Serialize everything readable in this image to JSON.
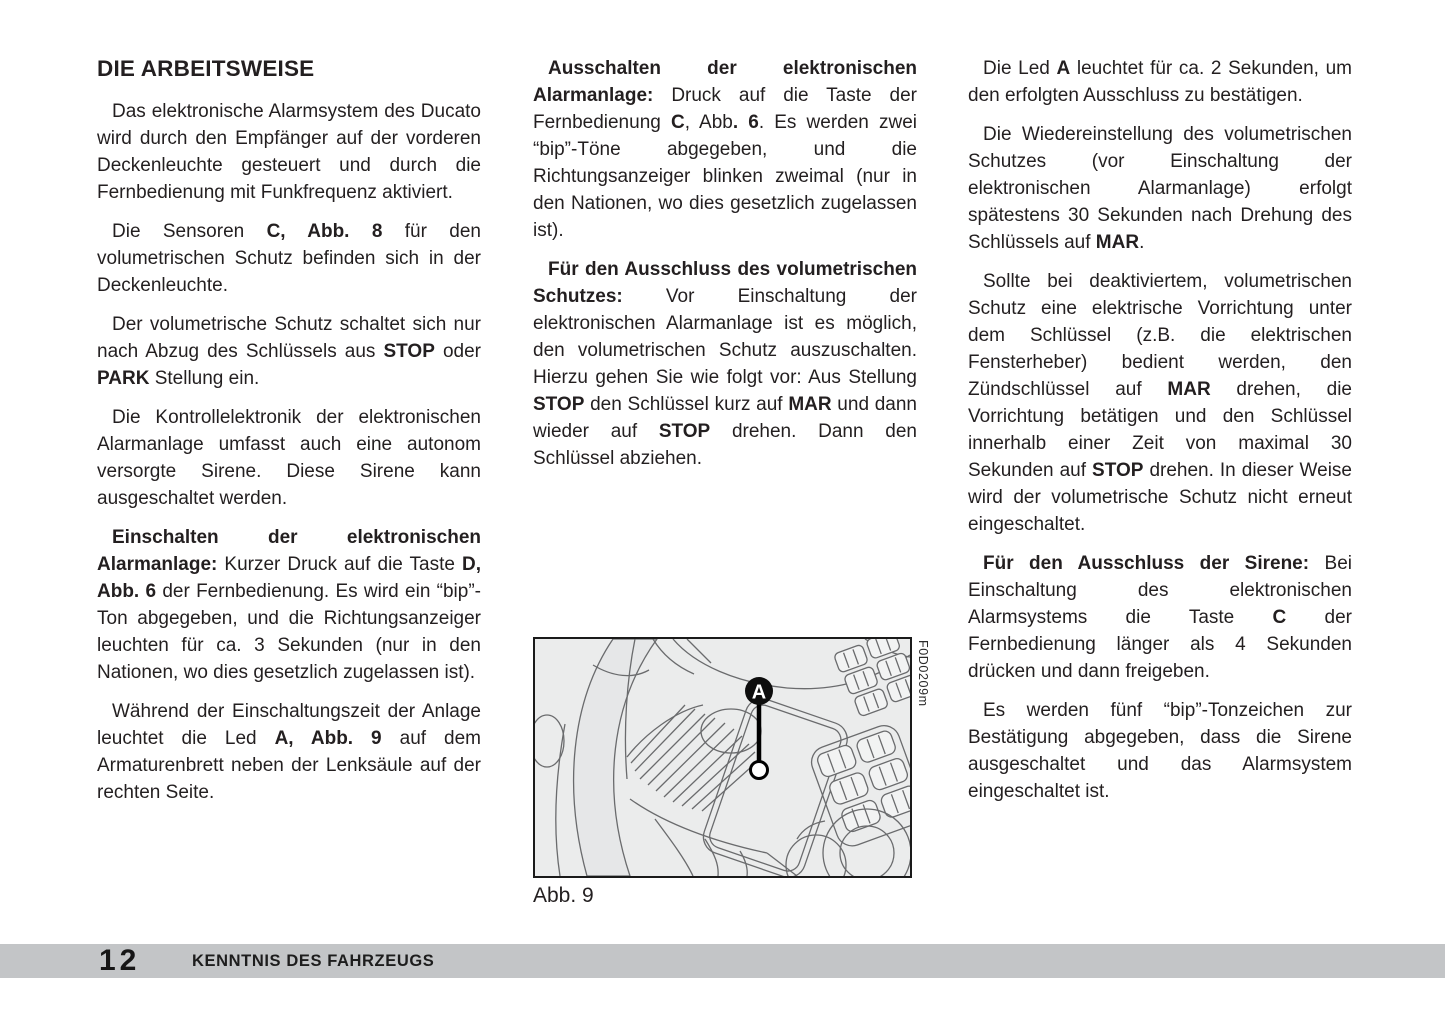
{
  "columns": {
    "left": {
      "heading": "DIE ARBEITSWEISE",
      "paragraphs": [
        {
          "segments": [
            {
              "t": "Das elektronische Alarmsystem des Ducato wird durch den Empfänger auf der vorderen Deckenleuchte gesteuert und durch die Fernbedienung mit Funkfrequenz aktiviert.",
              "b": false
            }
          ]
        },
        {
          "segments": [
            {
              "t": "Die Sensoren ",
              "b": false
            },
            {
              "t": "C, Abb. 8",
              "b": true
            },
            {
              "t": " für den volumetrischen Schutz befinden sich in der Deckenleuchte.",
              "b": false
            }
          ]
        },
        {
          "segments": [
            {
              "t": "Der volumetrische Schutz schaltet sich nur nach Abzug des Schlüssels aus ",
              "b": false
            },
            {
              "t": "STOP",
              "b": true
            },
            {
              "t": " oder ",
              "b": false
            },
            {
              "t": "PARK",
              "b": true
            },
            {
              "t": " Stellung ein.",
              "b": false
            }
          ]
        },
        {
          "segments": [
            {
              "t": "Die Kontrollelektronik der elektronischen Alarmanlage umfasst auch eine autonom versorgte Sirene. Diese Sirene kann ausgeschaltet werden.",
              "b": false
            }
          ]
        },
        {
          "segments": [
            {
              "t": "Einschalten der elektronischen Alarmanlage:",
              "b": true
            },
            {
              "t": " Kurzer Druck auf die Taste ",
              "b": false
            },
            {
              "t": "D, Abb. 6",
              "b": true
            },
            {
              "t": " der Fernbedienung. Es wird ein “bip”-Ton abgegeben, und die Richtungsanzeiger leuchten für ca. 3 Sekunden (nur in den Nationen, wo dies gesetzlich zugelassen ist).",
              "b": false
            }
          ]
        },
        {
          "segments": [
            {
              "t": "Während der Einschaltungszeit der Anlage leuchtet die Led ",
              "b": false
            },
            {
              "t": "A, Abb. 9",
              "b": true
            },
            {
              "t": " auf dem Armaturenbrett neben der Lenksäule auf der rechten Seite.",
              "b": false
            }
          ]
        }
      ]
    },
    "middle": {
      "paragraphs": [
        {
          "segments": [
            {
              "t": "Ausschalten der elektronischen Alarmanlage:",
              "b": true
            },
            {
              "t": " Druck auf die Taste der Fernbedienung ",
              "b": false
            },
            {
              "t": "C",
              "b": true
            },
            {
              "t": ", Abb",
              "b": false
            },
            {
              "t": ". 6",
              "b": true
            },
            {
              "t": ". Es werden zwei “bip”-Töne abgegeben, und die Richtungsanzeiger blinken zweimal (nur in den Nationen, wo dies gesetzlich zugelassen ist).",
              "b": false
            }
          ]
        },
        {
          "segments": [
            {
              "t": "Für den Ausschluss des volumetrischen Schutzes:",
              "b": true
            },
            {
              "t": " Vor Einschaltung der elektronischen Alarmanlage ist es möglich, den volumetrischen Schutz auszuschalten. Hierzu gehen Sie wie folgt vor: Aus Stellung ",
              "b": false
            },
            {
              "t": "STOP",
              "b": true
            },
            {
              "t": " den Schlüssel kurz auf ",
              "b": false
            },
            {
              "t": "MAR",
              "b": true
            },
            {
              "t": " und dann wieder auf ",
              "b": false
            },
            {
              "t": "STOP",
              "b": true
            },
            {
              "t": " drehen. Dann den Schlüssel abziehen.",
              "b": false
            }
          ]
        }
      ]
    },
    "right": {
      "paragraphs": [
        {
          "segments": [
            {
              "t": "Die Led ",
              "b": false
            },
            {
              "t": "A",
              "b": true
            },
            {
              "t": " leuchtet für ca. 2 Sekunden, um den erfolgten Ausschluss zu bestätigen.",
              "b": false
            }
          ]
        },
        {
          "segments": [
            {
              "t": "Die Wiedereinstellung des volumetrischen Schutzes (vor Einschaltung der elektronischen Alarmanlage) erfolgt spätestens 30 Sekunden nach Drehung des Schlüssels auf ",
              "b": false
            },
            {
              "t": "MAR",
              "b": true
            },
            {
              "t": ".",
              "b": false
            }
          ]
        },
        {
          "segments": [
            {
              "t": "Sollte bei deaktiviertem, volumetrischen Schutz eine elektrische Vorrichtung unter dem Schlüssel (z.B. die elektrischen Fensterheber) bedient werden, den Zündschlüssel auf ",
              "b": false
            },
            {
              "t": "MAR",
              "b": true
            },
            {
              "t": " drehen, die Vorrichtung betätigen und den Schlüssel innerhalb einer Zeit von maximal 30 Sekunden auf ",
              "b": false
            },
            {
              "t": "STOP",
              "b": true
            },
            {
              "t": " drehen. In dieser Weise wird der volumetrische Schutz nicht erneut eingeschaltet.",
              "b": false
            }
          ]
        },
        {
          "segments": [
            {
              "t": "Für den Ausschluss der Sirene:",
              "b": true
            },
            {
              "t": " Bei Einschaltung des elektronischen Alarmsystems die Taste ",
              "b": false
            },
            {
              "t": "C",
              "b": true
            },
            {
              "t": " der Fernbedienung länger als 4 Sekunden drücken und dann freigeben.",
              "b": false
            }
          ]
        },
        {
          "segments": [
            {
              "t": "Es werden fünf “bip”-Tonzeichen zur Bestätigung abgegeben, dass die Sirene ausgeschaltet und das Alarmsystem eingeschaltet ist.",
              "b": false
            }
          ]
        }
      ]
    }
  },
  "figure": {
    "caption": "Abb. 9",
    "code": "F0D0209m",
    "marker_label": "A"
  },
  "footer": {
    "page_number": "12",
    "section_title": "KENNTNIS DES FAHRZEUGS",
    "bar_color": "#c3c5c7"
  }
}
